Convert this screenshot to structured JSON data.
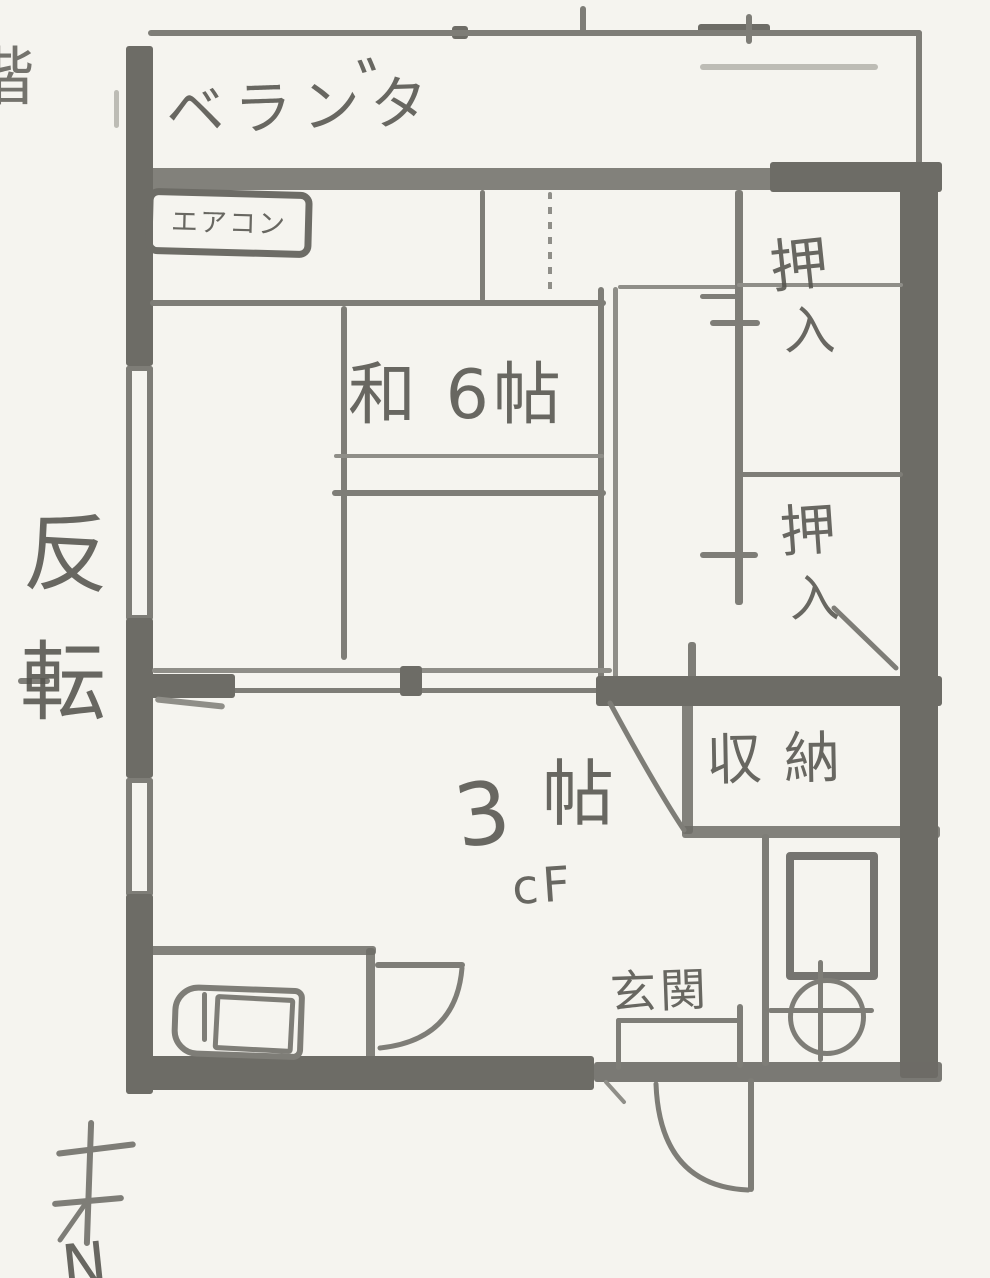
{
  "page": {
    "partial_floor_char": "階"
  },
  "balcony": {
    "label": "ベランタ",
    "dakuten": "゛"
  },
  "aircon_label": "エアコン",
  "washitsu_label": "和 6帖",
  "closet_upper": {
    "line1": "押",
    "line2": "入"
  },
  "closet_lower": {
    "line1": "押",
    "line2": "入"
  },
  "storage_label": "収納",
  "kitchen": {
    "num": "3",
    "unit": "帖",
    "floor_type": "cF"
  },
  "entrance_label": "玄関",
  "side_note": {
    "char1": "反",
    "char2": "転"
  },
  "compass_letter": "N",
  "colors": {
    "paper": "#f5f4ef",
    "pencil_dark": "#6d6c66",
    "pencil_med": "#7e7d77",
    "pencil_thin": "#8f8e88",
    "pencil_faint": "#bdbcb5",
    "text": "#55544e"
  }
}
